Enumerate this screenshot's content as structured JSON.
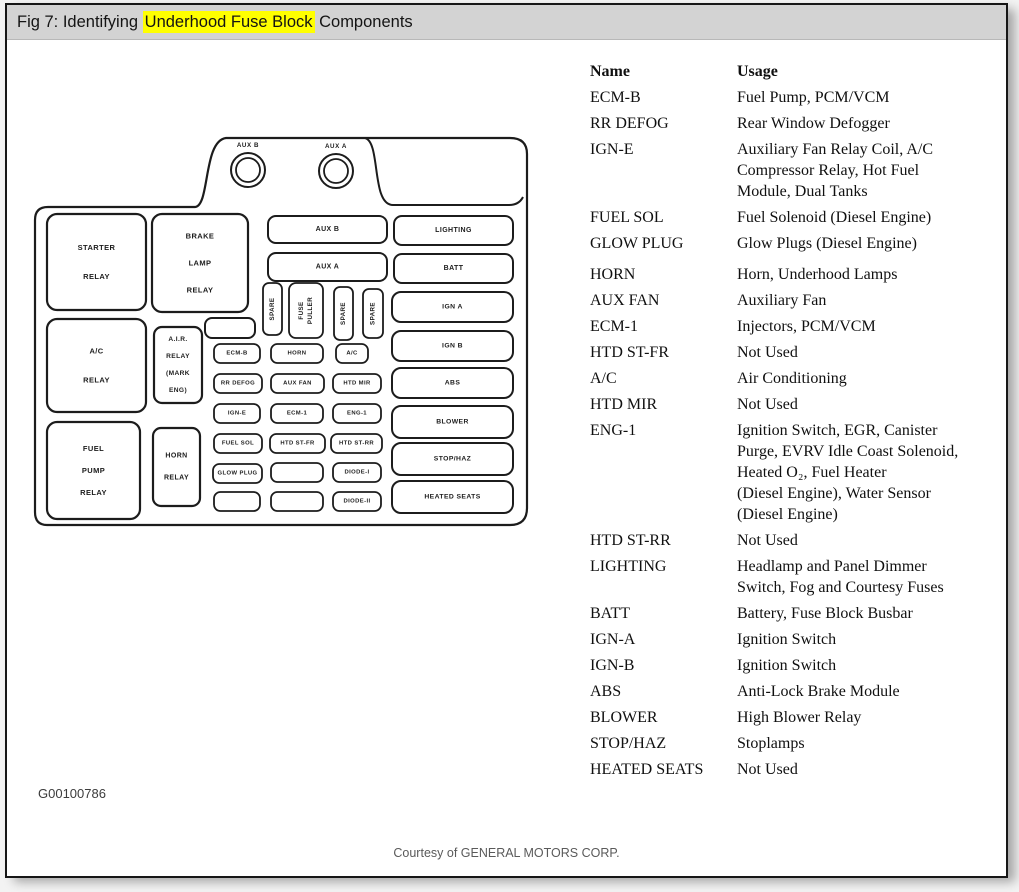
{
  "window": {
    "title_prefix": "Fig 7: Identifying ",
    "title_highlight": "Underhood Fuse Block",
    "title_suffix": " Components",
    "highlight_color": "#ffff00",
    "titlebar_bg": "#d3d3d3",
    "border_color": "#161616"
  },
  "figure_id": "G00100786",
  "courtesy": "Courtesy of GENERAL MOTORS CORP.",
  "fuse_table": {
    "headers": {
      "name": "Name",
      "usage": "Usage"
    },
    "rows": [
      {
        "name": "ECM-B",
        "usage": [
          "Fuel Pump, PCM/VCM"
        ]
      },
      {
        "name": "RR DEFOG",
        "usage": [
          "Rear Window Defogger"
        ]
      },
      {
        "name": "IGN-E",
        "usage": [
          "Auxiliary Fan Relay Coil, A/C",
          "Compressor Relay, Hot Fuel",
          "Module, Dual Tanks"
        ]
      },
      {
        "name": "FUEL SOL",
        "usage": [
          "Fuel Solenoid (Diesel Engine)"
        ]
      },
      {
        "name": "GLOW PLUG",
        "usage": [
          "Glow Plugs (Diesel Engine)"
        ]
      },
      {
        "name": "HORN",
        "usage": [
          "Horn, Underhood Lamps"
        ],
        "gap_before": true
      },
      {
        "name": "AUX FAN",
        "usage": [
          "Auxiliary Fan"
        ]
      },
      {
        "name": "ECM-1",
        "usage": [
          "Injectors, PCM/VCM"
        ]
      },
      {
        "name": "HTD ST-FR",
        "usage": [
          "Not Used"
        ]
      },
      {
        "name": "A/C",
        "usage": [
          "Air Conditioning"
        ]
      },
      {
        "name": "HTD MIR",
        "usage": [
          "Not Used"
        ]
      },
      {
        "name": "ENG-1",
        "usage": [
          "Ignition Switch, EGR, Canister",
          "Purge, EVRV Idle Coast Solenoid,",
          "Heated O₂, Fuel Heater",
          "(Diesel Engine), Water Sensor",
          "(Diesel Engine)"
        ]
      },
      {
        "name": "HTD ST-RR",
        "usage": [
          "Not Used"
        ]
      },
      {
        "name": "LIGHTING",
        "usage": [
          "Headlamp and Panel Dimmer",
          "Switch, Fog and Courtesy Fuses"
        ]
      },
      {
        "name": "BATT",
        "usage": [
          "Battery, Fuse Block Busbar"
        ]
      },
      {
        "name": "IGN-A",
        "usage": [
          "Ignition Switch"
        ]
      },
      {
        "name": "IGN-B",
        "usage": [
          "Ignition Switch"
        ]
      },
      {
        "name": "ABS",
        "usage": [
          "Anti-Lock Brake Module"
        ]
      },
      {
        "name": "BLOWER",
        "usage": [
          "High Blower Relay"
        ]
      },
      {
        "name": "STOP/HAZ",
        "usage": [
          "Stoplamps"
        ]
      },
      {
        "name": "HEATED SEATS",
        "usage": [
          "Not Used"
        ]
      }
    ]
  },
  "diagram": {
    "ink": "#1c1c1c",
    "towers": [
      {
        "label": "AUX B",
        "cx": 248,
        "cy": 170
      },
      {
        "label": "AUX A",
        "cx": 336,
        "cy": 171
      }
    ],
    "boxes": [
      {
        "x": 47,
        "y": 214,
        "w": 99,
        "h": 96,
        "r": 10,
        "sw": 2.2,
        "fs": 7.5,
        "lg": 29,
        "lines": [
          "STARTER",
          "RELAY"
        ]
      },
      {
        "x": 152,
        "y": 214,
        "w": 96,
        "h": 98,
        "r": 10,
        "sw": 2.2,
        "fs": 7.5,
        "lg": 27,
        "lines": [
          "BRAKE",
          "LAMP",
          "RELAY"
        ]
      },
      {
        "x": 47,
        "y": 319,
        "w": 99,
        "h": 93,
        "r": 10,
        "sw": 2.2,
        "fs": 7.5,
        "lg": 29,
        "lines": [
          "A/C",
          "RELAY"
        ]
      },
      {
        "x": 154,
        "y": 327,
        "w": 48,
        "h": 76,
        "r": 8,
        "sw": 2.2,
        "fs": 6.6,
        "lg": 17,
        "lines": [
          "A.I.R.",
          "RELAY",
          "(MARK",
          "ENG)"
        ]
      },
      {
        "x": 47,
        "y": 422,
        "w": 93,
        "h": 97,
        "r": 10,
        "sw": 2.2,
        "fs": 7.5,
        "lg": 22,
        "lines": [
          "FUEL",
          "PUMP",
          "RELAY"
        ]
      },
      {
        "x": 153,
        "y": 428,
        "w": 47,
        "h": 78,
        "r": 8,
        "sw": 2.2,
        "fs": 7,
        "lg": 22,
        "lines": [
          "HORN",
          "RELAY"
        ]
      },
      {
        "x": 205,
        "y": 318,
        "w": 50,
        "h": 20,
        "r": 7,
        "sw": 2,
        "lines": []
      },
      {
        "x": 268,
        "y": 216,
        "w": 119,
        "h": 27,
        "r": 8,
        "sw": 2,
        "fs": 7,
        "lines": [
          "AUX B"
        ]
      },
      {
        "x": 268,
        "y": 253,
        "w": 119,
        "h": 28,
        "r": 8,
        "sw": 2,
        "fs": 7,
        "lines": [
          "AUX A"
        ]
      },
      {
        "x": 394,
        "y": 216,
        "w": 119,
        "h": 29,
        "r": 8,
        "sw": 2,
        "fs": 7,
        "lines": [
          "LIGHTING"
        ]
      },
      {
        "x": 394,
        "y": 254,
        "w": 119,
        "h": 29,
        "r": 8,
        "sw": 2,
        "fs": 7,
        "lines": [
          "BATT"
        ]
      },
      {
        "x": 263,
        "y": 283,
        "w": 19,
        "h": 52,
        "r": 6,
        "sw": 1.8,
        "fs": 6.2,
        "vert": true,
        "lines": [
          "SPARE"
        ]
      },
      {
        "x": 289,
        "y": 283,
        "w": 34,
        "h": 55,
        "r": 7,
        "sw": 1.8,
        "fs": 6.2,
        "lg": 9,
        "vert": true,
        "lines": [
          "FUSE",
          "PULLER"
        ]
      },
      {
        "x": 334,
        "y": 287,
        "w": 19,
        "h": 53,
        "r": 6,
        "sw": 1.8,
        "fs": 6.2,
        "vert": true,
        "lines": [
          "SPARE"
        ]
      },
      {
        "x": 363,
        "y": 289,
        "w": 20,
        "h": 49,
        "r": 6,
        "sw": 1.8,
        "fs": 6.2,
        "vert": true,
        "lines": [
          "SPARE"
        ]
      },
      {
        "x": 214,
        "y": 344,
        "w": 46,
        "h": 19,
        "lines": [
          "ECM-B"
        ]
      },
      {
        "x": 214,
        "y": 374,
        "w": 48,
        "h": 19,
        "lines": [
          "RR DEFOG"
        ]
      },
      {
        "x": 214,
        "y": 404,
        "w": 46,
        "h": 19,
        "lines": [
          "IGN-E"
        ]
      },
      {
        "x": 214,
        "y": 434,
        "w": 48,
        "h": 19,
        "lines": [
          "FUEL SOL"
        ]
      },
      {
        "x": 213,
        "y": 464,
        "w": 49,
        "h": 19,
        "lines": [
          "GLOW PLUG"
        ]
      },
      {
        "x": 214,
        "y": 492,
        "w": 46,
        "h": 19,
        "lines": []
      },
      {
        "x": 271,
        "y": 344,
        "w": 52,
        "h": 19,
        "lines": [
          "HORN"
        ]
      },
      {
        "x": 271,
        "y": 374,
        "w": 53,
        "h": 19,
        "lines": [
          "AUX FAN"
        ]
      },
      {
        "x": 271,
        "y": 404,
        "w": 52,
        "h": 19,
        "lines": [
          "ECM-1"
        ]
      },
      {
        "x": 270,
        "y": 434,
        "w": 55,
        "h": 19,
        "lines": [
          "HTD ST-FR"
        ]
      },
      {
        "x": 271,
        "y": 463,
        "w": 52,
        "h": 19,
        "lines": []
      },
      {
        "x": 271,
        "y": 492,
        "w": 52,
        "h": 19,
        "lines": []
      },
      {
        "x": 336,
        "y": 344,
        "w": 32,
        "h": 19,
        "lines": [
          "A/C"
        ]
      },
      {
        "x": 333,
        "y": 374,
        "w": 48,
        "h": 19,
        "lines": [
          "HTD MIR"
        ]
      },
      {
        "x": 333,
        "y": 404,
        "w": 48,
        "h": 19,
        "lines": [
          "ENG-1"
        ]
      },
      {
        "x": 331,
        "y": 434,
        "w": 51,
        "h": 19,
        "lines": [
          "HTD ST-RR"
        ]
      },
      {
        "x": 333,
        "y": 463,
        "w": 48,
        "h": 19,
        "lines": [
          "DIODE-I"
        ]
      },
      {
        "x": 333,
        "y": 492,
        "w": 48,
        "h": 19,
        "lines": [
          "DIODE-II"
        ]
      },
      {
        "x": 392,
        "y": 292,
        "w": 121,
        "h": 30,
        "r": 9,
        "sw": 2,
        "fs": 6.8,
        "lines": [
          "IGN A"
        ]
      },
      {
        "x": 392,
        "y": 331,
        "w": 121,
        "h": 30,
        "r": 9,
        "sw": 2,
        "fs": 6.8,
        "lines": [
          "IGN B"
        ]
      },
      {
        "x": 392,
        "y": 368,
        "w": 121,
        "h": 30,
        "r": 9,
        "sw": 2,
        "fs": 6.8,
        "lines": [
          "ABS"
        ]
      },
      {
        "x": 392,
        "y": 406,
        "w": 121,
        "h": 32,
        "r": 9,
        "sw": 2,
        "fs": 6.8,
        "lines": [
          "BLOWER"
        ]
      },
      {
        "x": 392,
        "y": 443,
        "w": 121,
        "h": 32,
        "r": 9,
        "sw": 2,
        "fs": 6.8,
        "lines": [
          "STOP/HAZ"
        ]
      },
      {
        "x": 392,
        "y": 481,
        "w": 121,
        "h": 32,
        "r": 9,
        "sw": 2,
        "fs": 6.8,
        "lines": [
          "HEATED SEATS"
        ]
      }
    ]
  }
}
